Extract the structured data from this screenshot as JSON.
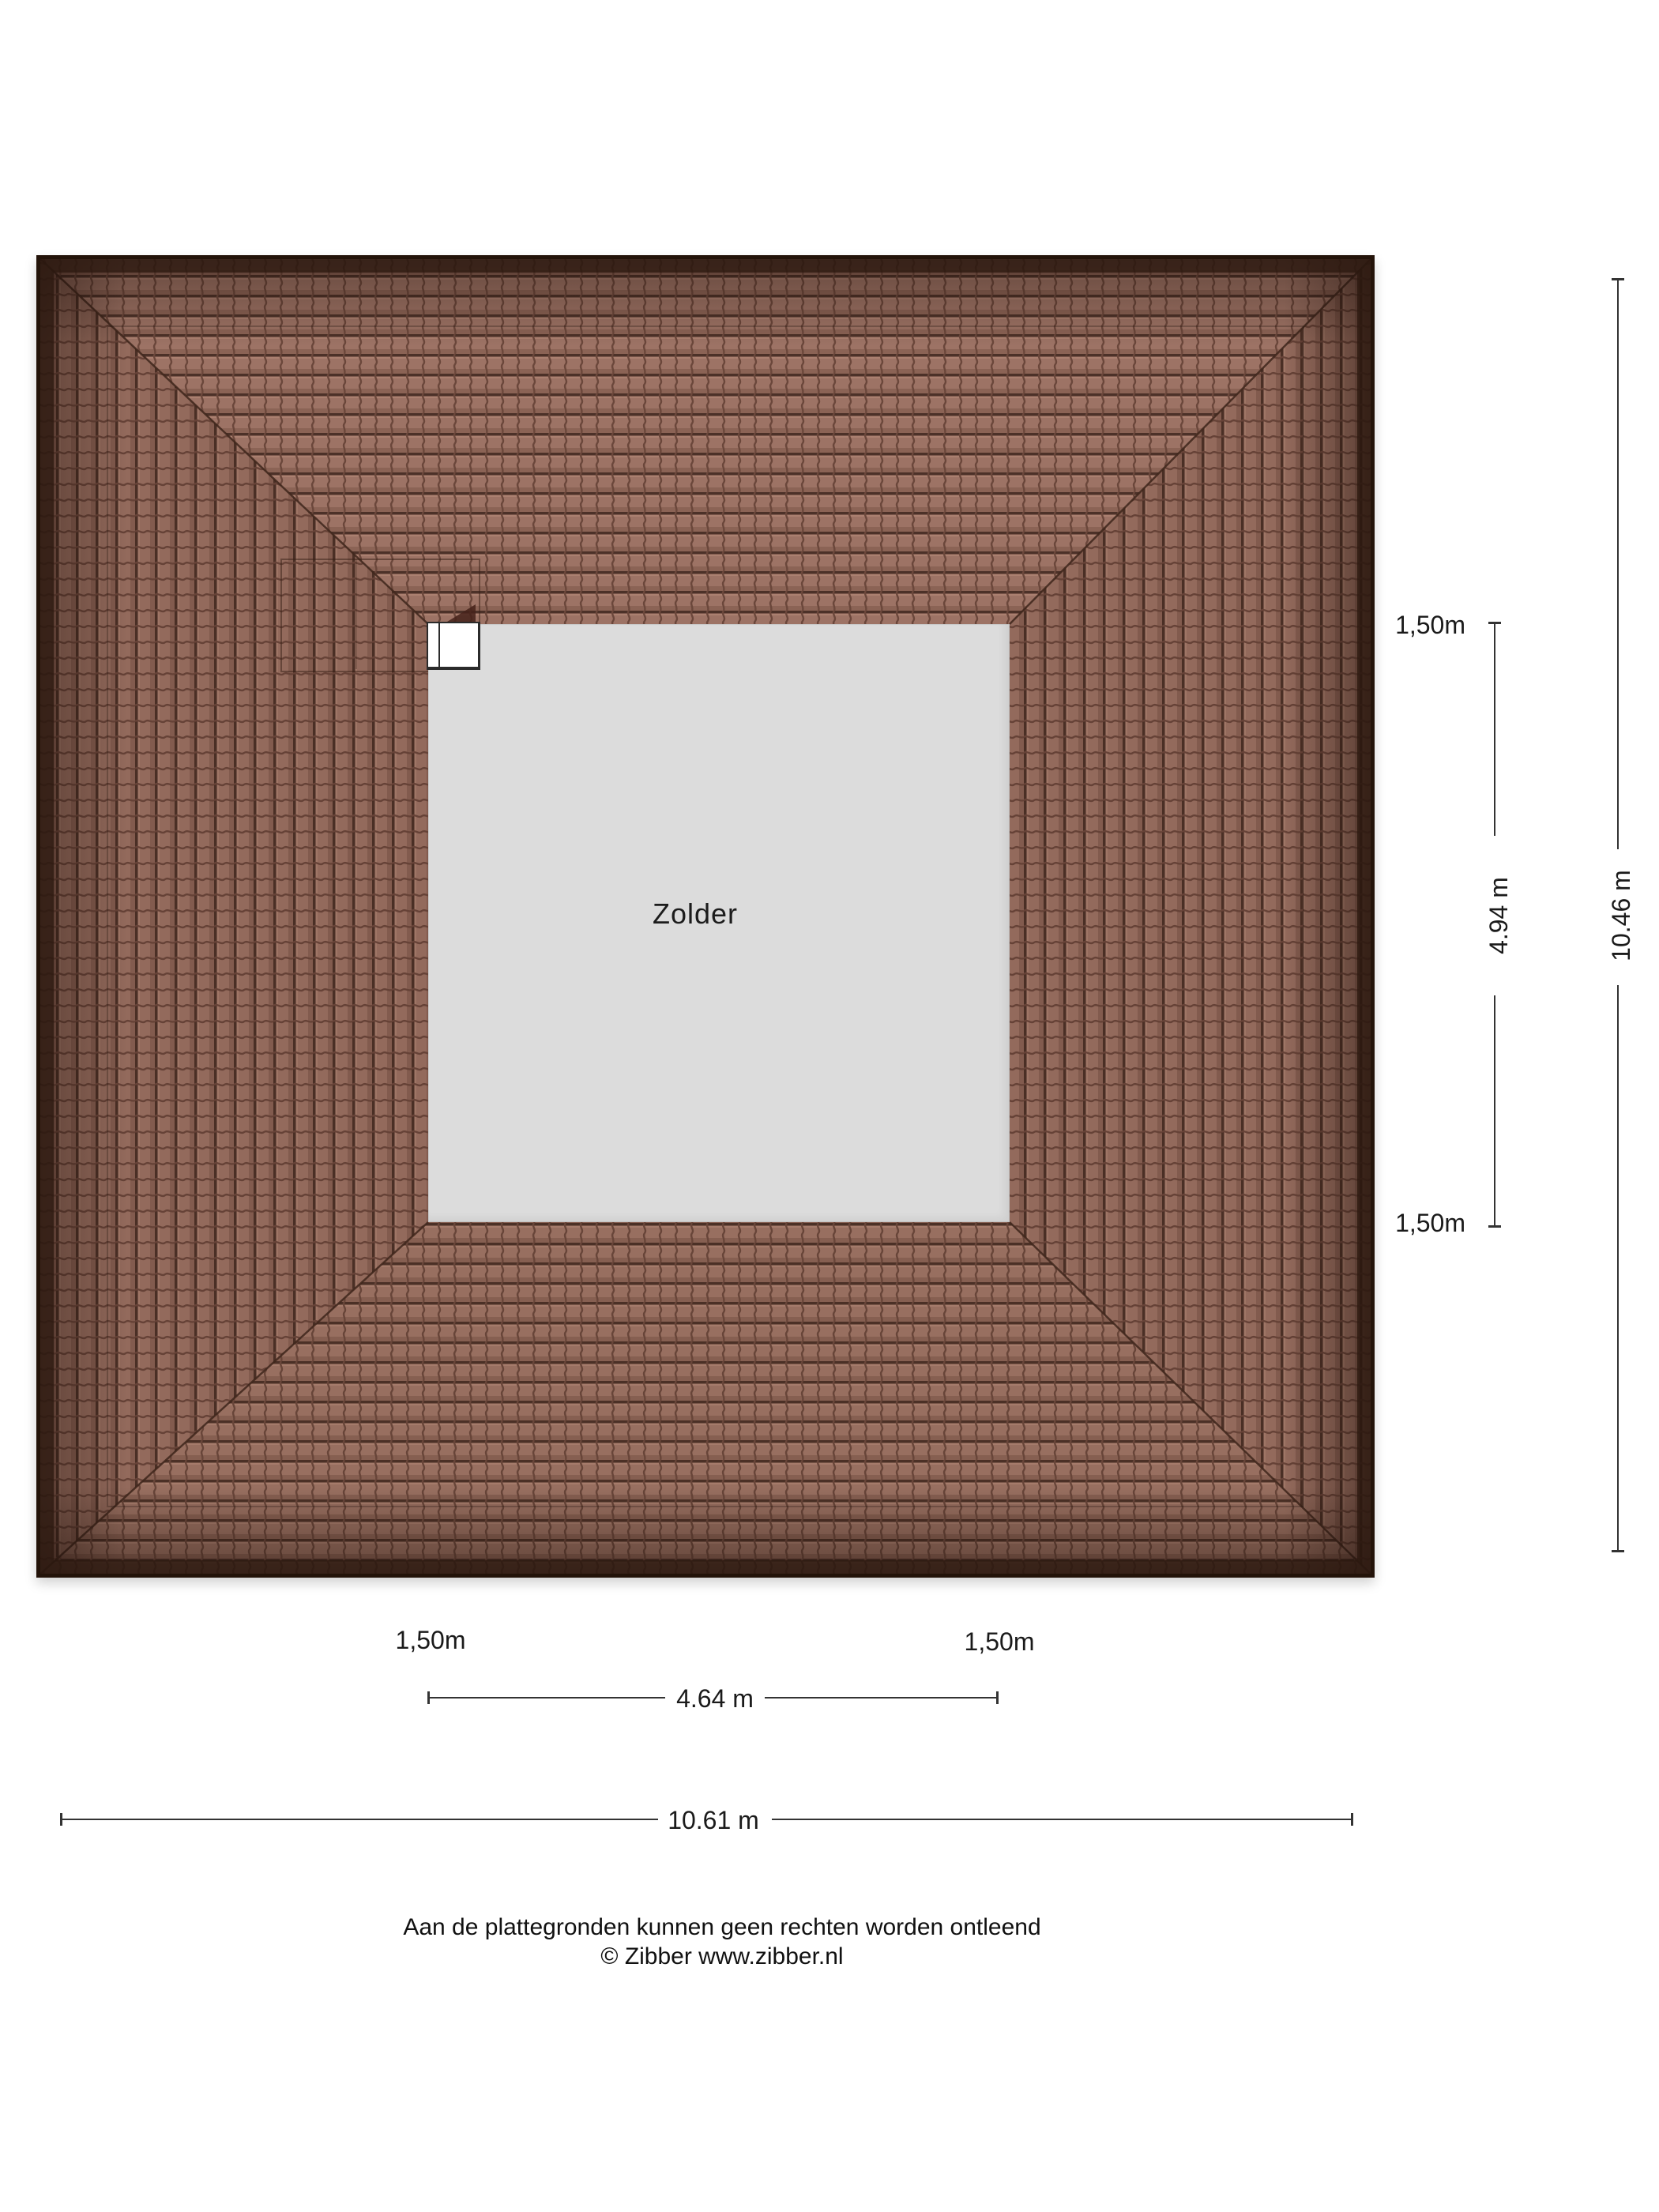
{
  "floorplan": {
    "room": {
      "label": "Zolder",
      "fill": "#dcdcdc"
    },
    "roof": {
      "tile_color": "#9d7365",
      "tile_joint_color": "#6b473b",
      "tile_row_line_color": "#4c3128",
      "border_color": "#231309"
    },
    "window": {
      "fill": "#ffffff",
      "frame_color": "#2b2b2b"
    },
    "dimension_line_color": "#333333",
    "dimensions": {
      "right": {
        "offset_top": "1,50m",
        "span": "4.94 m",
        "offset_bottom": "1,50m",
        "total": "10.46 m"
      },
      "bottom": {
        "offset_left": "1,50m",
        "span": "4.64 m",
        "offset_right": "1,50m",
        "total": "10.61 m"
      }
    },
    "footer": {
      "disclaimer": "Aan de plattegronden kunnen geen rechten worden ontleend",
      "copyright": "© Zibber www.zibber.nl"
    }
  }
}
